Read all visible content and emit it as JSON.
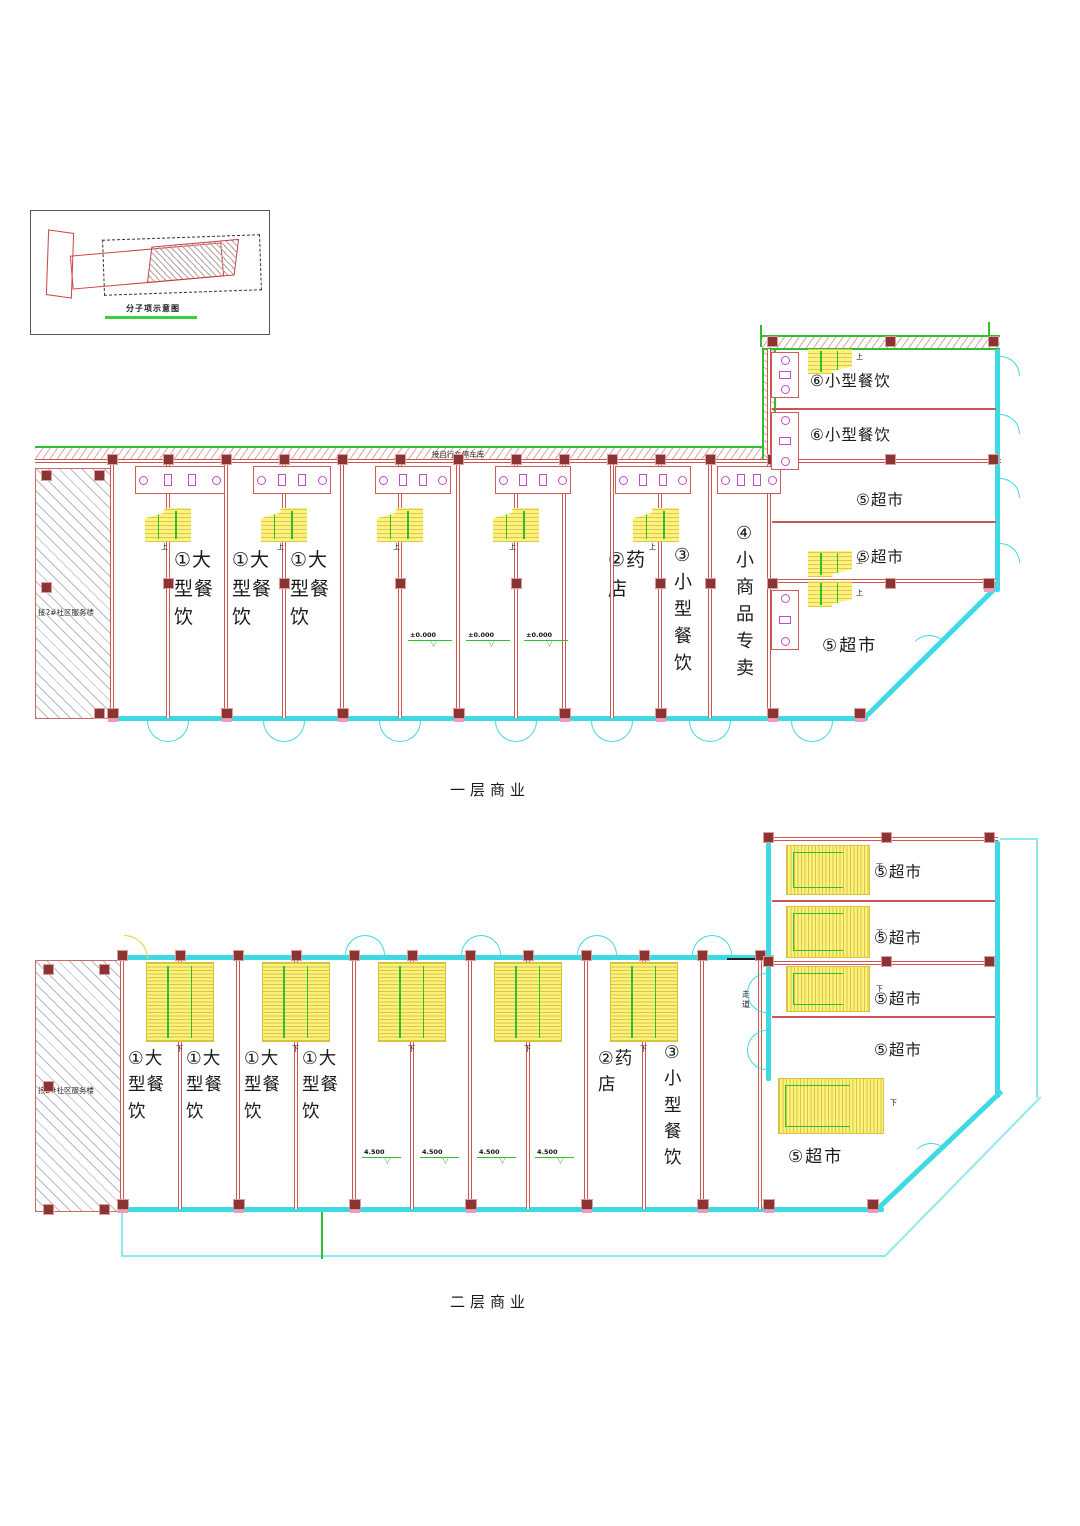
{
  "inset": {
    "caption": "分子项示意图"
  },
  "symbols": {
    "elevation_triangle": "▽"
  },
  "floor1": {
    "title": "一层商业",
    "annex_label": "接2#社区服务楼",
    "ramp_label": "接自行车停车库",
    "unit_labels": [
      "①大型餐饮",
      "①大型餐饮",
      "①大型餐饮",
      "②药店",
      "③小型餐饮",
      "④小商品专卖"
    ],
    "wing_labels": [
      "⑥小型餐饮",
      "⑥小型餐饮",
      "⑤超市",
      "⑤超市",
      "⑤超市"
    ],
    "elevations": [
      "±0.000",
      "±0.000",
      "±0.000"
    ],
    "stair_mark": "上"
  },
  "floor2": {
    "title": "二层商业",
    "annex_label": "接2#社区服务楼",
    "corridor_label": "走道",
    "unit_labels": [
      "①大型餐饮",
      "①大型餐饮",
      "①大型餐饮",
      "①大型餐饮",
      "②药店",
      "③小型餐饮"
    ],
    "wing_labels": [
      "⑤超市",
      "⑤超市",
      "⑤超市",
      "⑤超市",
      "⑤超市"
    ],
    "elevations": [
      "4.500",
      "4.500",
      "4.500",
      "4.500"
    ],
    "stair_mark": "下"
  }
}
